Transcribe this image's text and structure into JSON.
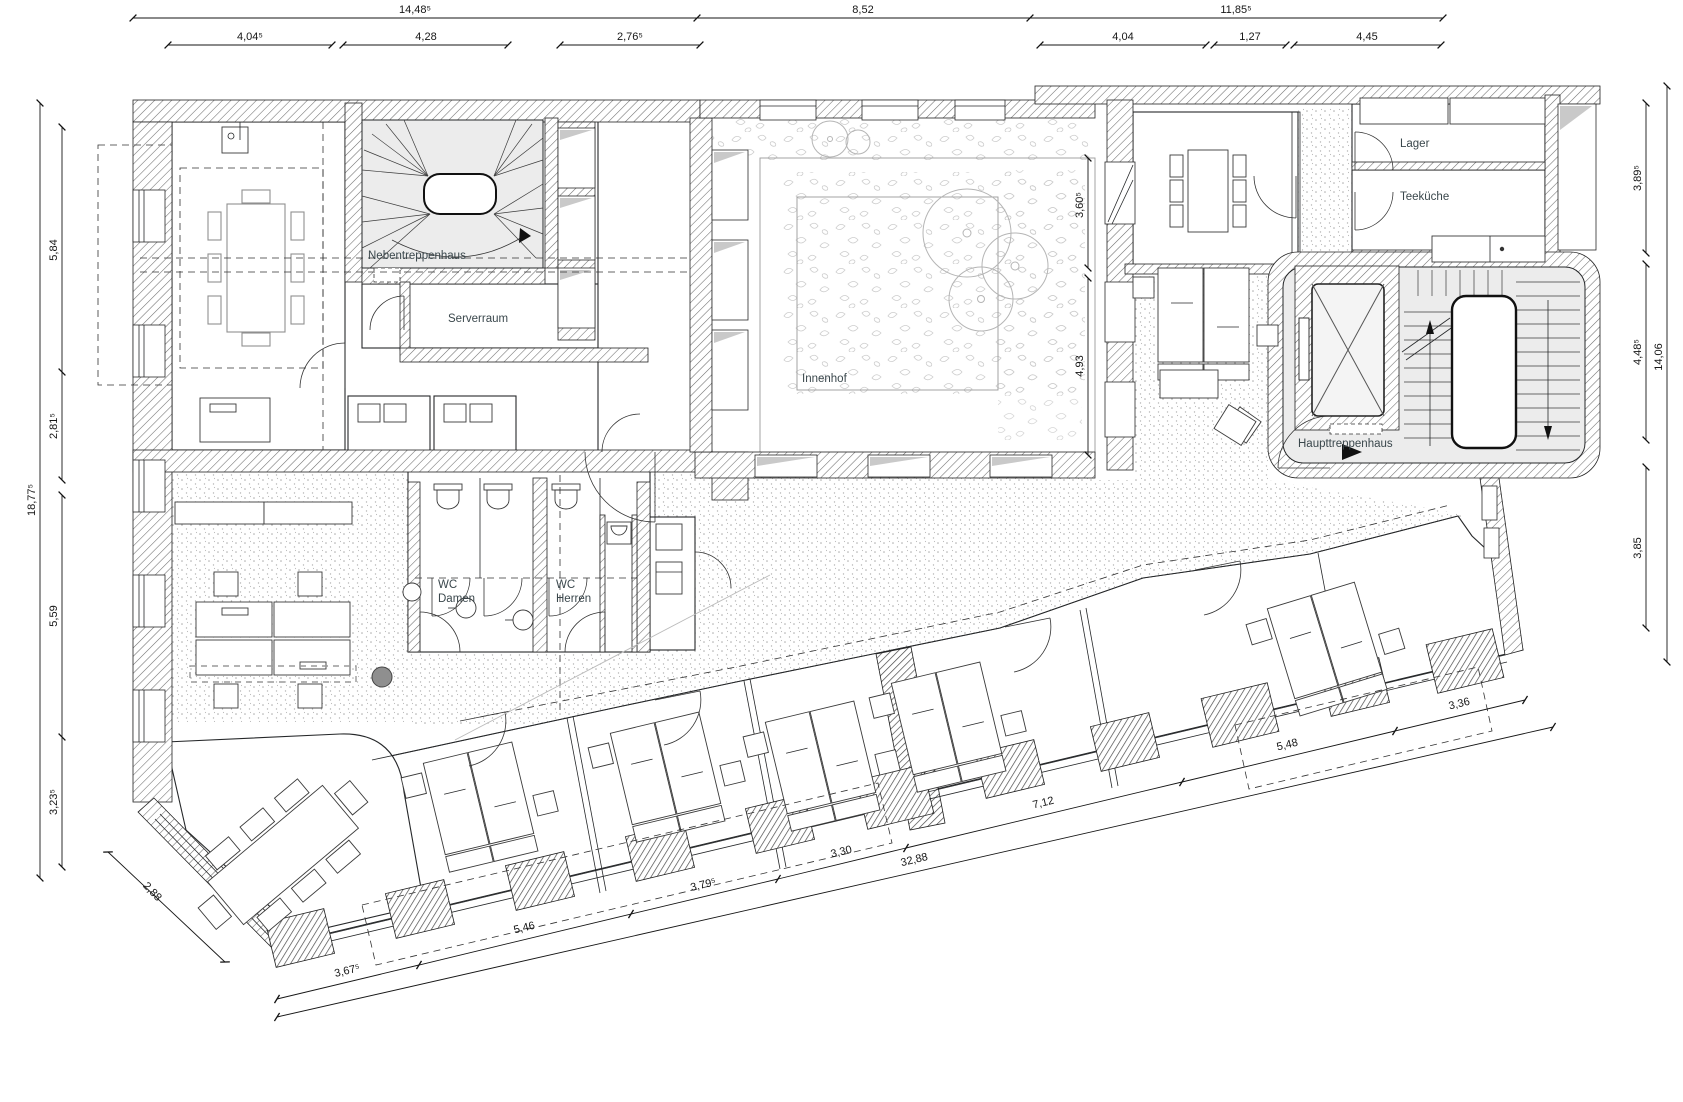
{
  "rooms": {
    "nebentreppenhaus": "Nebentreppenhaus",
    "serverraum": "Serverraum",
    "innenhof": "Innenhof",
    "lager": "Lager",
    "teekueche": "Teeküche",
    "haupttreppenhaus": "Haupttreppenhaus",
    "wc": "WC",
    "damen": "Damen",
    "herren": "Herren"
  },
  "dims": {
    "top_outer": [
      "14,48⁵",
      "8,52",
      "11,85⁵"
    ],
    "top_inner": [
      "4,04⁵",
      "4,28",
      "2,76⁵",
      "4,04",
      "1,27",
      "4,45"
    ],
    "left_outer": "18,77⁵",
    "left_inner": [
      "5,84",
      "2,81⁵",
      "5,59",
      "3,23⁵"
    ],
    "left_corner": "2,88",
    "right_outer": "14,06",
    "right_inner": [
      "3,89⁵",
      "4,48⁵",
      "3,85"
    ],
    "courtyard": [
      "3,60⁵",
      "4,93"
    ],
    "bottom_outer": "32,88",
    "bottom_inner": [
      "3,67⁵",
      "5,46",
      "3,79⁵",
      "3,30",
      "7,12",
      "5,48",
      "3,36"
    ]
  }
}
